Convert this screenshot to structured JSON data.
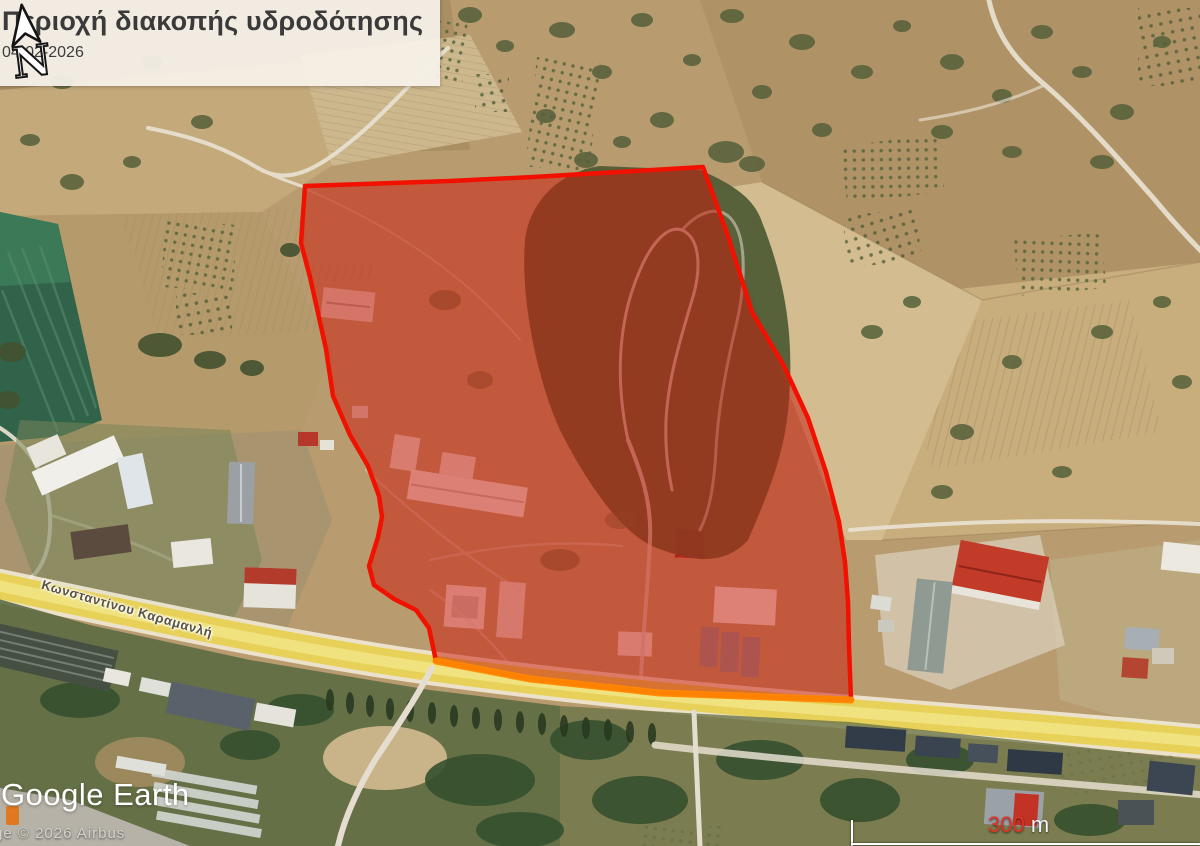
{
  "legend": {
    "title": "Περιοχή διακοπής υδροδότησης",
    "date": "04-02-2026"
  },
  "map": {
    "road_label": "Κωνσταντίνου Καραμανλή",
    "overlay": {
      "label": "water-outage-area",
      "fill": "rgba(204,26,13,0.52)",
      "stroke": "#f21000",
      "road_edge_stroke": "#ff8800"
    }
  },
  "attribution": {
    "logo": "Google Earth",
    "copyright": "Image © 2026 Airbus"
  },
  "scale_bar": {
    "value": "300",
    "unit": " m"
  },
  "compass": {
    "letter": "N"
  }
}
